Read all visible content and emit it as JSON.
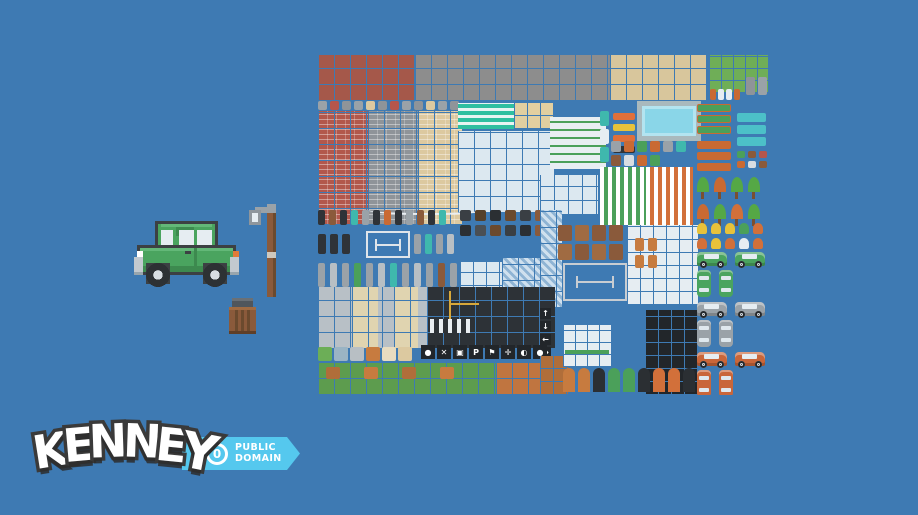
{
  "background": {
    "color": "#3e7ab3"
  },
  "logo": {
    "text": "KENNEY",
    "letters": [
      "K",
      "E",
      "N",
      "N",
      "E",
      "Y"
    ],
    "badge": {
      "icon": "0",
      "line1": "PUBLIC",
      "line2": "DOMAIN",
      "ribbon_color": "#55c8ee",
      "text_color": "#ffffff"
    }
  },
  "preview": {
    "car": {
      "name": "green-pixel-car",
      "body": "#4aa45f",
      "body_light": "#63b878",
      "body_shade": "#3d8a4f",
      "line": "#3c4043",
      "window": "#e6edf2",
      "wheel": "#2d3134",
      "hub": "#d8dde2",
      "bumper": "#c2c9cf",
      "bumper_shade": "#98a5ad",
      "headlight": "#ffffff",
      "taillight": "#e07b39"
    },
    "lamp": {
      "name": "street-lamp",
      "pole": "#8a5a3b",
      "pole_shade": "#6b4a2e",
      "band": "#cfc8bd",
      "head": "#8f969c",
      "arm": "#9aa2a8",
      "light": "#e6edf2"
    },
    "trash": {
      "name": "trash-barrel",
      "lid": "#50565c",
      "lid_top": "#6a7076",
      "body": "#8a5a3b",
      "plank": "#6b4a2e",
      "rim": "#a06b42",
      "base": "#5f3f28"
    }
  },
  "spritesheet": {
    "x": 318,
    "y": 53,
    "width": 450,
    "height": 342,
    "regions": [
      {
        "id": "roof-red",
        "kind": "tiles",
        "x": 0,
        "y": 2,
        "w": 97,
        "h": 46,
        "c": "#a5584a",
        "t": 16
      },
      {
        "id": "roof-gray",
        "kind": "tiles",
        "x": 97,
        "y": 2,
        "w": 195,
        "h": 46,
        "c": "#8d8d8d",
        "t": 16
      },
      {
        "id": "roof-tan",
        "kind": "tiles",
        "x": 292,
        "y": 2,
        "w": 97,
        "h": 46,
        "c": "#d8c69c",
        "t": 16
      },
      {
        "id": "grass-court",
        "kind": "tiles",
        "x": 391,
        "y": 2,
        "w": 59,
        "h": 38,
        "c": "#6fae57",
        "t": 12
      },
      {
        "id": "court-statues",
        "kind": "items",
        "x": 428,
        "y": 24,
        "w": 22,
        "h": 22,
        "iw": 9,
        "ih": 18,
        "gap": 3,
        "colors": [
          "#8f9499",
          "#9aa2a8"
        ]
      },
      {
        "id": "court-props",
        "kind": "items",
        "x": 392,
        "y": 36,
        "w": 34,
        "h": 12,
        "iw": 6,
        "ih": 11,
        "gap": 2,
        "colors": [
          "#c96a33",
          "#e6edf2",
          "#e6edf2",
          "#c96a33"
        ]
      },
      {
        "id": "wall-caps",
        "kind": "items",
        "x": 0,
        "y": 48,
        "w": 142,
        "h": 10,
        "iw": 9,
        "ih": 9,
        "gap": 3,
        "colors": [
          "#9aa2a8",
          "#b5564c",
          "#8f9499",
          "#9aa2a8",
          "#dcc9a0",
          "#8f9499",
          "#b5564c",
          "#9aa2a8",
          "#8f9499",
          "#dcc9a0",
          "#9aa2a8",
          "#8f9499"
        ]
      },
      {
        "id": "brick-red",
        "kind": "brick",
        "x": 0,
        "y": 58,
        "w": 50,
        "h": 114,
        "c": "#b2584c"
      },
      {
        "id": "brick-gray",
        "kind": "brick",
        "x": 50,
        "y": 58,
        "w": 50,
        "h": 114,
        "c": "#8f9499"
      },
      {
        "id": "brick-tan",
        "kind": "brick",
        "x": 100,
        "y": 58,
        "w": 44,
        "h": 114,
        "c": "#dcc9a0"
      },
      {
        "id": "awning-teal",
        "kind": "stripesH",
        "x": 140,
        "y": 50,
        "w": 68,
        "h": 26,
        "c": "#2fbfa0",
        "c2": "#e8f4f2",
        "s1": 4,
        "s2": 3
      },
      {
        "id": "arch-tan",
        "kind": "tiles",
        "x": 196,
        "y": 50,
        "w": 40,
        "h": 26,
        "c": "#e2cfa0",
        "t": 13
      },
      {
        "id": "windows-white-a",
        "kind": "tiles",
        "x": 140,
        "y": 78,
        "w": 96,
        "h": 82,
        "c": "#dce8f0",
        "t": 16
      },
      {
        "id": "windows-green-bands",
        "kind": "stripesH",
        "x": 232,
        "y": 64,
        "w": 56,
        "h": 52,
        "c": "#e8eef2",
        "c2": "#4ba05a",
        "s1": 6,
        "s2": 2
      },
      {
        "id": "arches-white",
        "kind": "tiles",
        "x": 222,
        "y": 122,
        "w": 58,
        "h": 40,
        "c": "#dce8f0",
        "t": 14
      },
      {
        "id": "pool",
        "kind": "pool",
        "x": 319,
        "y": 48,
        "w": 64,
        "h": 40,
        "c": "#8ad6e8",
        "c2": "#a9b9bd"
      },
      {
        "id": "vending-teal",
        "kind": "items",
        "x": 282,
        "y": 58,
        "w": 11,
        "h": 54,
        "iw": 9,
        "ih": 15,
        "gap": 3,
        "colors": [
          "#3fb8ad",
          "#e6edf2",
          "#3fb8ad"
        ]
      },
      {
        "id": "barriers",
        "kind": "items",
        "x": 295,
        "y": 60,
        "w": 24,
        "h": 48,
        "iw": 22,
        "ih": 7,
        "gap": 4,
        "colors": [
          "#e0703a",
          "#e8c23a",
          "#e0703a",
          "#2f3338"
        ]
      },
      {
        "id": "street-props",
        "kind": "items",
        "x": 293,
        "y": 88,
        "w": 84,
        "h": 26,
        "iw": 10,
        "ih": 11,
        "gap": 3,
        "colors": [
          "#9aa2a8",
          "#c96a33",
          "#4ba05a",
          "#c96a33",
          "#9aa2a8",
          "#3fb8ad",
          "#8a5a3b",
          "#d8dde2",
          "#c96a33",
          "#4ba05a"
        ]
      },
      {
        "id": "planters-green",
        "kind": "items",
        "x": 379,
        "y": 51,
        "w": 36,
        "h": 34,
        "iw": 34,
        "ih": 8,
        "gap": 3,
        "bd": "1px solid #c96a33",
        "colors": [
          "#4ba05a",
          "#4ba05a",
          "#4ba05a"
        ]
      },
      {
        "id": "crates-teal",
        "kind": "items",
        "x": 419,
        "y": 60,
        "w": 31,
        "h": 34,
        "iw": 29,
        "ih": 9,
        "gap": 3,
        "colors": [
          "#4cc0c8",
          "#4cc0c8",
          "#4cc0c8"
        ]
      },
      {
        "id": "planters-orange",
        "kind": "items",
        "x": 379,
        "y": 88,
        "w": 36,
        "h": 32,
        "iw": 34,
        "ih": 8,
        "gap": 3,
        "colors": [
          "#c96a33",
          "#c96a33",
          "#c96a33"
        ]
      },
      {
        "id": "small-props-right",
        "kind": "items",
        "x": 419,
        "y": 98,
        "w": 31,
        "h": 24,
        "iw": 8,
        "ih": 7,
        "gap": 3,
        "colors": [
          "#4ba05a",
          "#8a5a3b",
          "#b5564c",
          "#c96a33",
          "#d8dde2",
          "#8a5a3b"
        ]
      },
      {
        "id": "awning-green-striped",
        "kind": "stripesV",
        "x": 282,
        "y": 114,
        "w": 46,
        "h": 58,
        "c": "#ffffff",
        "c2": "#4ba05a",
        "s1": 4,
        "s2": 4
      },
      {
        "id": "awning-orange-striped",
        "kind": "stripesV",
        "x": 328,
        "y": 114,
        "w": 47,
        "h": 58,
        "c": "#ffffff",
        "c2": "#d2703a",
        "s1": 4,
        "s2": 4
      },
      {
        "id": "trees",
        "kind": "items",
        "x": 379,
        "y": 124,
        "w": 71,
        "h": 56,
        "iw": 12,
        "ih": 22,
        "gap": 5,
        "tree": true,
        "colors": [
          "#55a845",
          "#c96a33",
          "#55a845",
          "#55a845",
          "#c96a33",
          "#55a845",
          "#d2703a",
          "#55a845"
        ]
      },
      {
        "id": "clothesline",
        "kind": "wire",
        "x": 50,
        "y": 152,
        "w": 118,
        "h": 10
      },
      {
        "id": "props-row-1",
        "kind": "items",
        "x": 0,
        "y": 157,
        "w": 142,
        "h": 20,
        "iw": 7,
        "ih": 15,
        "gap": 4,
        "colors": [
          "#2f3338",
          "#8a5a3b",
          "#2f3338",
          "#3fb8ad",
          "#9aa2a8",
          "#2f3338",
          "#c96a33",
          "#2f3338",
          "#9aa2a8",
          "#8a5a3b",
          "#2f3338",
          "#3fb8ad"
        ]
      },
      {
        "id": "props-rocks",
        "kind": "items",
        "x": 142,
        "y": 157,
        "w": 95,
        "h": 50,
        "iw": 11,
        "ih": 11,
        "gap": 4,
        "colors": [
          "#3a3f44",
          "#55402a",
          "#2b2f33",
          "#6b4a2e",
          "#3a3f44",
          "#8a5a3b",
          "#2b2f33",
          "#4a4f54",
          "#6b4a2e",
          "#3a3f44",
          "#2b2f33",
          "#8a5a3b"
        ]
      },
      {
        "id": "traffic-lights",
        "kind": "items",
        "x": 0,
        "y": 181,
        "w": 44,
        "h": 24,
        "iw": 8,
        "ih": 20,
        "gap": 4,
        "colors": [
          "#2f3338",
          "#2f3338",
          "#2f3338"
        ]
      },
      {
        "id": "floorplan-small",
        "kind": "outline",
        "x": 48,
        "y": 178,
        "w": 44,
        "h": 27,
        "c": "#dfe5ea"
      },
      {
        "id": "poles",
        "kind": "items",
        "x": 96,
        "y": 181,
        "w": 46,
        "h": 24,
        "iw": 7,
        "ih": 20,
        "gap": 4,
        "colors": [
          "#9aa2a8",
          "#3fb8ad",
          "#9aa2a8",
          "#b8bfc4"
        ]
      },
      {
        "id": "street-lamps",
        "kind": "items",
        "x": 0,
        "y": 210,
        "w": 142,
        "h": 26,
        "iw": 7,
        "ih": 24,
        "gap": 5,
        "colors": [
          "#9aa2a8",
          "#b8bfc4",
          "#9aa2a8",
          "#4ba05a",
          "#9aa2a8",
          "#b8bfc4",
          "#3fb8ad",
          "#9aa2a8",
          "#b8bfc4",
          "#9aa2a8",
          "#8a5a3b",
          "#9aa2a8"
        ]
      },
      {
        "id": "windows-white-b",
        "kind": "tiles",
        "x": 142,
        "y": 209,
        "w": 42,
        "h": 50,
        "c": "#dce8f0",
        "t": 13
      },
      {
        "id": "tarp-hatch-a",
        "kind": "hatch",
        "x": 184,
        "y": 205,
        "w": 38,
        "h": 55,
        "c": "#cfe0ee",
        "c2": "#8fb4d4"
      },
      {
        "id": "tarp-hatch-b",
        "kind": "hatch",
        "x": 222,
        "y": 157,
        "w": 22,
        "h": 98,
        "c": "#cfe0ee",
        "c2": "#8fb4d4"
      },
      {
        "id": "fences-brown",
        "kind": "items",
        "x": 240,
        "y": 172,
        "w": 66,
        "h": 38,
        "iw": 14,
        "ih": 16,
        "gap": 3,
        "colors": [
          "#8a5a3b",
          "#a06b42",
          "#8a5a3b",
          "#8a5a3b",
          "#a06b42",
          "#8a5a3b",
          "#a06b42",
          "#8a5a3b"
        ]
      },
      {
        "id": "floorplan-large",
        "kind": "outline",
        "x": 245,
        "y": 210,
        "w": 64,
        "h": 38,
        "c": "#c8cdd2"
      },
      {
        "id": "window-frames-block",
        "kind": "tiles",
        "x": 309,
        "y": 172,
        "w": 71,
        "h": 80,
        "c": "#e6edf2",
        "t": 13
      },
      {
        "id": "window-frames-orange",
        "kind": "items",
        "x": 317,
        "y": 185,
        "w": 24,
        "h": 36,
        "iw": 9,
        "ih": 13,
        "gap": 4,
        "colors": [
          "#c77b3f",
          "#c77b3f",
          "#c77b3f",
          "#c77b3f"
        ]
      },
      {
        "id": "windows-dark",
        "kind": "tiles",
        "x": 327,
        "y": 257,
        "w": 53,
        "h": 85,
        "c": "#22262a",
        "t": 13
      },
      {
        "id": "sidewalk",
        "kind": "tiles",
        "x": 0,
        "y": 234,
        "w": 109,
        "h": 62,
        "c": "#b8c0c6",
        "t": 16
      },
      {
        "id": "sidewalk-tan-col1",
        "kind": "tiles",
        "x": 34,
        "y": 234,
        "w": 26,
        "h": 62,
        "c": "#e0d4b0",
        "t": 16
      },
      {
        "id": "sidewalk-tan-col2",
        "kind": "tiles",
        "x": 76,
        "y": 234,
        "w": 24,
        "h": 62,
        "c": "#e0d4b0",
        "t": 16
      },
      {
        "id": "road",
        "kind": "tiles",
        "x": 109,
        "y": 234,
        "w": 128,
        "h": 62,
        "c": "#2d3237",
        "t": 16
      },
      {
        "id": "road-line-yellow-v",
        "kind": "solid",
        "x": 131,
        "y": 238,
        "w": 2,
        "h": 28,
        "c": "#d8a83a"
      },
      {
        "id": "road-line-yellow-h",
        "kind": "solid",
        "x": 133,
        "y": 250,
        "w": 28,
        "h": 2,
        "c": "#d8a83a"
      },
      {
        "id": "crosswalk",
        "kind": "stripesV",
        "x": 112,
        "y": 266,
        "w": 40,
        "h": 14,
        "c": "#e9eef2",
        "c2": "#2d3237",
        "s1": 4,
        "s2": 5
      },
      {
        "id": "road-sign-arrows",
        "kind": "glyphs",
        "x": 222,
        "y": 255,
        "w": 23,
        "h": 52,
        "t": 11,
        "c": "#22262a",
        "fs": 8,
        "glyphs": [
          "↑",
          "↓",
          "←",
          "→"
        ]
      },
      {
        "id": "road-icon-tiles",
        "kind": "glyphs",
        "x": 103,
        "y": 292,
        "w": 126,
        "h": 16,
        "t": 14,
        "c": "#22262a",
        "fs": 8,
        "glyphs": [
          "●",
          "✕",
          "▣",
          "P",
          "⚑",
          "✛",
          "◐",
          "●"
        ]
      },
      {
        "id": "edge-tiles",
        "kind": "items",
        "x": 0,
        "y": 294,
        "w": 103,
        "h": 15,
        "iw": 14,
        "ih": 14,
        "gap": 2,
        "colors": [
          "#6cae57",
          "#9ab4c4",
          "#b8bfc4",
          "#c77b3f",
          "#e8dcc0",
          "#dcc9a0"
        ]
      },
      {
        "id": "grass",
        "kind": "tiles",
        "x": 0,
        "y": 310,
        "w": 178,
        "h": 32,
        "c": "#5d9c4e",
        "t": 16
      },
      {
        "id": "grass-dirt-patches",
        "kind": "items",
        "x": 8,
        "y": 314,
        "w": 166,
        "h": 26,
        "iw": 14,
        "ih": 12,
        "gap": 24,
        "colors": [
          "#b06e3a",
          "#c77b3f",
          "#b06e3a",
          "#c77b3f"
        ]
      },
      {
        "id": "dirt",
        "kind": "tiles",
        "x": 178,
        "y": 310,
        "w": 44,
        "h": 32,
        "c": "#c07540",
        "t": 16
      },
      {
        "id": "dirt-2",
        "kind": "tiles",
        "x": 222,
        "y": 303,
        "w": 28,
        "h": 39,
        "c": "#b06e3a",
        "t": 13
      },
      {
        "id": "storefront",
        "kind": "tiles",
        "x": 245,
        "y": 272,
        "w": 48,
        "h": 42,
        "c": "#e6edf2",
        "t": 12
      },
      {
        "id": "storefront-stripe",
        "kind": "solid",
        "x": 247,
        "y": 297,
        "w": 44,
        "h": 4,
        "c": "#4ba05a"
      },
      {
        "id": "doors-row",
        "kind": "items",
        "x": 245,
        "y": 315,
        "w": 133,
        "h": 26,
        "iw": 12,
        "ih": 24,
        "gap": 3,
        "r": "6px 6px 0 0",
        "colors": [
          "#c77b3f",
          "#c77b3f",
          "#2b2f33",
          "#4ba05a",
          "#4ba05a",
          "#2b2f33",
          "#d2703a",
          "#d2703a",
          "#2b2f33"
        ]
      },
      {
        "id": "market-row",
        "kind": "items",
        "x": 379,
        "y": 170,
        "w": 71,
        "h": 27,
        "iw": 10,
        "ih": 11,
        "gap": 4,
        "r": "50% 50% 20% 20%",
        "colors": [
          "#e8c23a",
          "#e8c23a",
          "#e8c23a",
          "#4ba05a",
          "#d2703a",
          "#d2703a",
          "#e8c23a",
          "#d2703a",
          "#e6edf2",
          "#d2703a"
        ]
      },
      {
        "id": "cars-green",
        "kind": "cars",
        "x": 379,
        "y": 199,
        "w": 71,
        "h": 48,
        "c": "#4aa45f"
      },
      {
        "id": "cars-gray",
        "kind": "cars",
        "x": 379,
        "y": 249,
        "w": 71,
        "h": 48,
        "c": "#9aa2a8"
      },
      {
        "id": "cars-orange",
        "kind": "cars",
        "x": 379,
        "y": 299,
        "w": 71,
        "h": 43,
        "c": "#c9663a"
      }
    ]
  }
}
